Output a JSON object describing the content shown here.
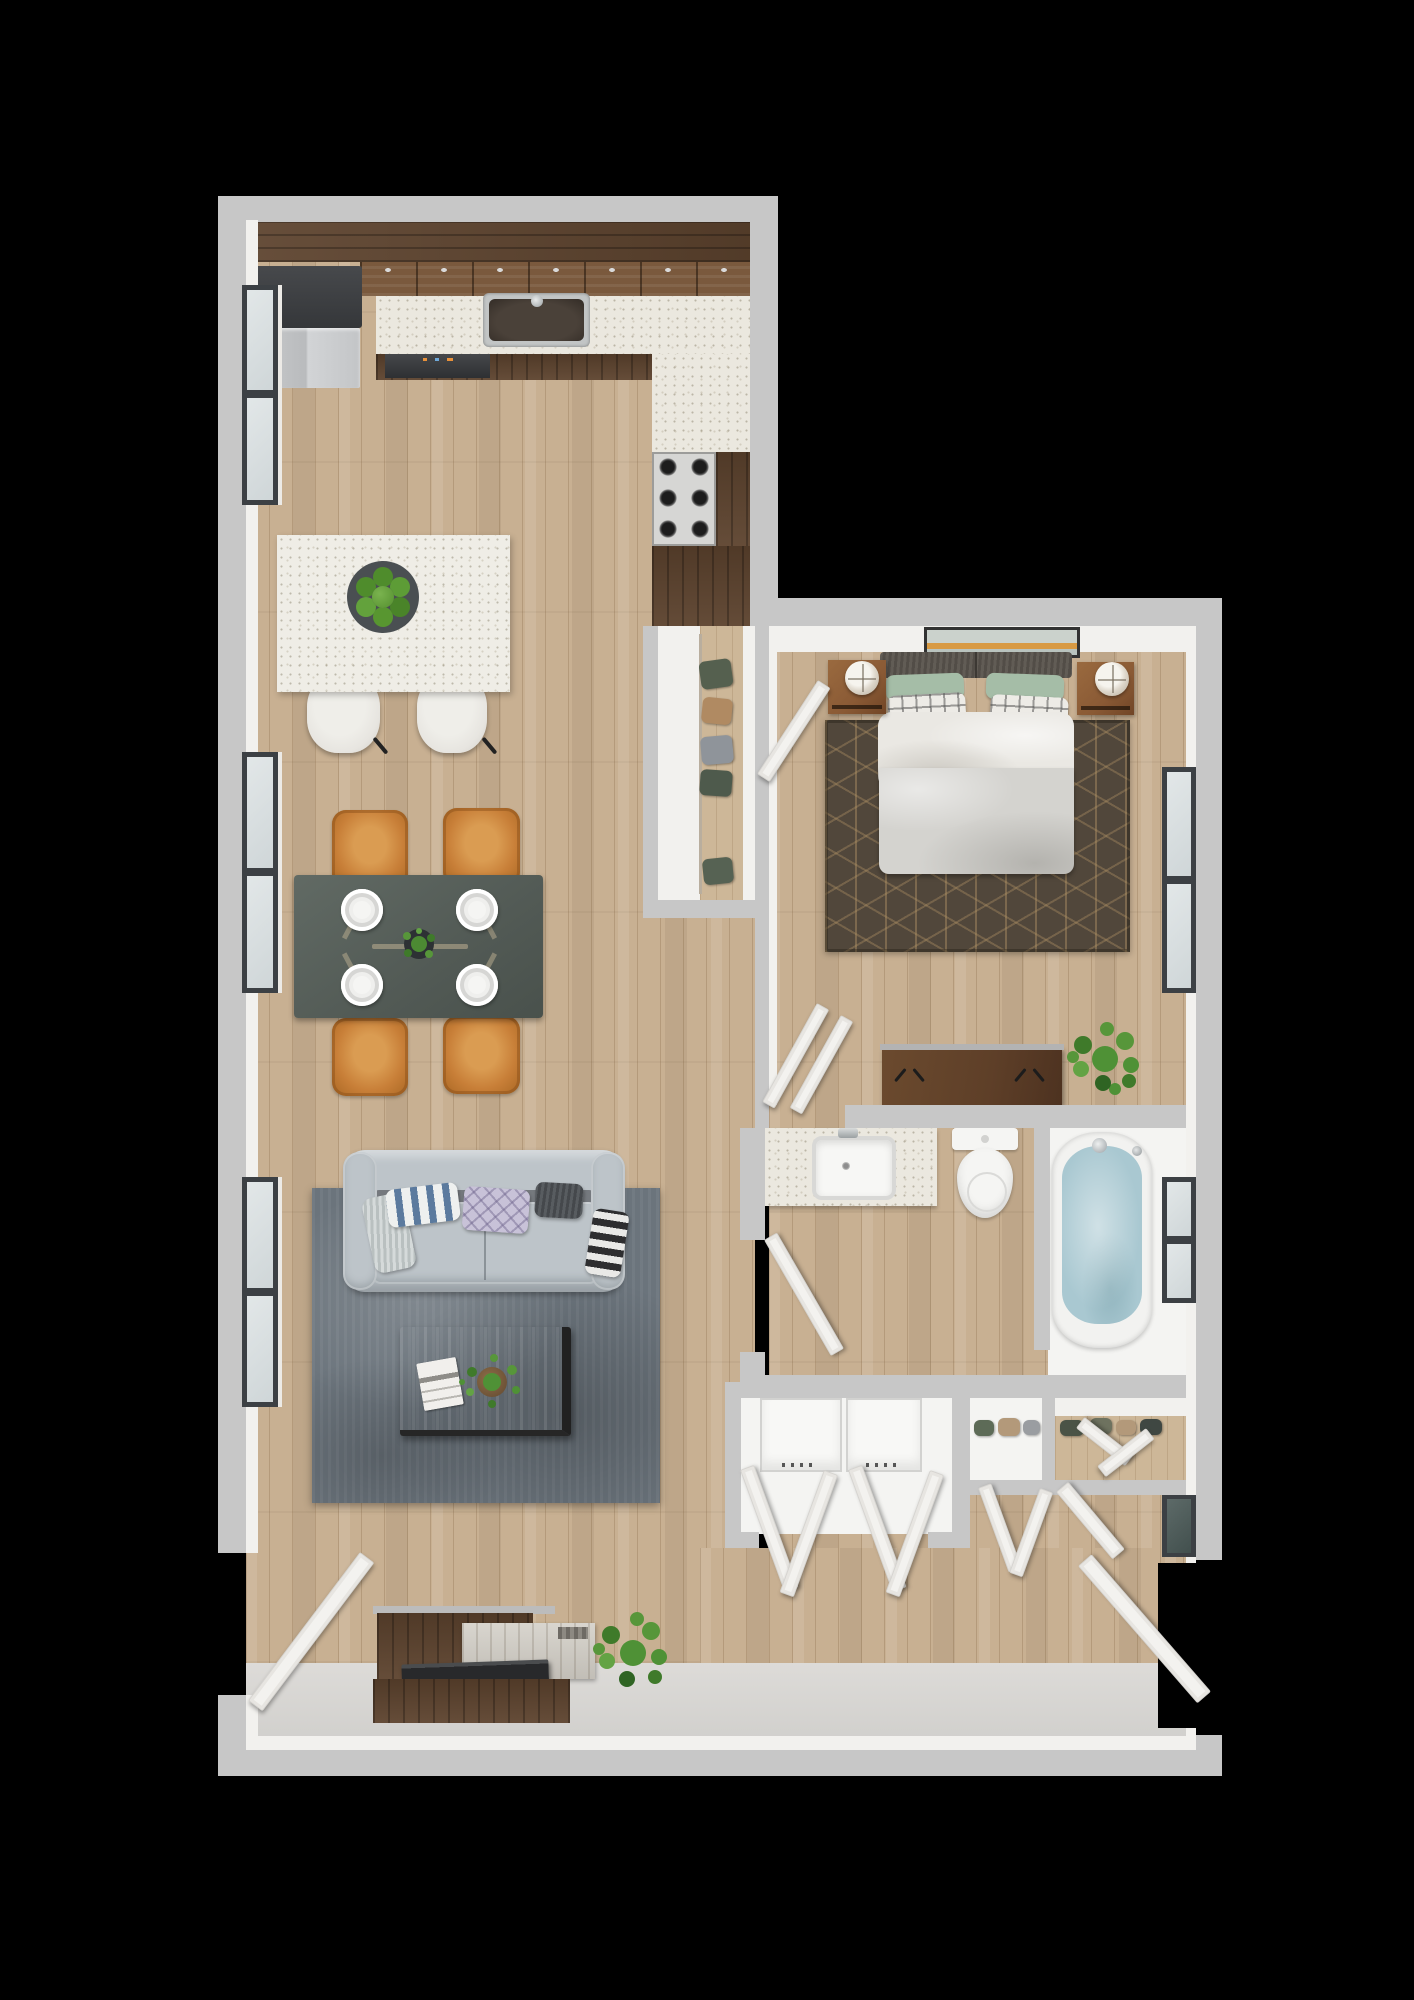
{
  "title": "3D top-down floor plan render of a one-bedroom apartment",
  "palette": {
    "bg": "#000000",
    "wall": "#c7c7c7",
    "liner": "#f2f1ee",
    "fixture": "#f4f4f2",
    "floorWood": "#c8b092",
    "counter": "#ebe8df",
    "walnut": "#5d432e",
    "walnutLight": "#7a593d",
    "island": "#efede6",
    "stool": "#e7e5e0",
    "chair": "#c87f38",
    "table": "#59615c",
    "sofa": "#bdc4c9",
    "rugLiving": "#6b747c",
    "rugBed": "#51473b",
    "rugBedLine": "#a68e66",
    "duvet": "#d4d3cf",
    "sheet": "#eae8e3",
    "headboard": "#59544e",
    "pillowGreen": "#a5bda7",
    "nightstand": "#8a5a35",
    "dresser": "#5e3f28",
    "water": "#a9c8d1",
    "apples": "#55902f",
    "plant": "#4c8a33",
    "door": "#f3f2ef",
    "glass": "#d9dedf",
    "frame": "#3c4044",
    "tv": "#28292b",
    "coffee": "#7d4e2c",
    "consoleWash": "#d2cec6"
  },
  "rooms": [
    {
      "id": "kitchen",
      "label": "Kitchen",
      "items": [
        "refrigerator",
        "upper cabinets",
        "countertop",
        "double sink",
        "dishwasher",
        "gas cooktop",
        "base cabinets",
        "kitchen island",
        "fruit bowl with green apples",
        "2 bar stools"
      ]
    },
    {
      "id": "dining",
      "label": "Dining Area",
      "items": [
        "dark dining table",
        "4 orange chairs",
        "4 place settings",
        "centerpiece plant"
      ]
    },
    {
      "id": "living",
      "label": "Living Room",
      "items": [
        "gray tufted sofa",
        "5 throw pillows",
        "blue-gray area rug",
        "walnut coffee table",
        "magazine",
        "potted plant",
        "media console",
        "television",
        "floor plant"
      ]
    },
    {
      "id": "bedroom",
      "label": "Bedroom",
      "items": [
        "queen bed",
        "tufted headboard",
        "green and plaid pillows",
        "gray duvet",
        "2 walnut nightstands",
        "2 round table lamps",
        "wall art",
        "hex-pattern rug",
        "low dresser",
        "potted plant"
      ]
    },
    {
      "id": "closet",
      "label": "Reach-in Closet",
      "items": [
        "5 hanging garments",
        "closet door"
      ]
    },
    {
      "id": "bathroom",
      "label": "Bathroom",
      "items": [
        "quartz vanity",
        "rectangular sink",
        "toilet",
        "soaking tub with water",
        "privacy half wall",
        "window"
      ]
    },
    {
      "id": "laundry",
      "label": "Laundry Closet",
      "items": [
        "washer",
        "dryer",
        "two bifold door pairs"
      ]
    },
    {
      "id": "storage",
      "label": "Hall Closets",
      "items": [
        "linen closet with shelf items",
        "entry closet with shelf items",
        "bifold doors"
      ]
    },
    {
      "id": "entry",
      "label": "Entry",
      "items": [
        "side entry door (left wall)",
        "main entry door (right wall)",
        "smooth gray entry floor"
      ]
    }
  ],
  "counts": {
    "windows": 6,
    "door_leaves": 13,
    "dining_chairs": 4,
    "bar_stools": 2,
    "plants": 5,
    "apples": 7,
    "plates": 4
  }
}
